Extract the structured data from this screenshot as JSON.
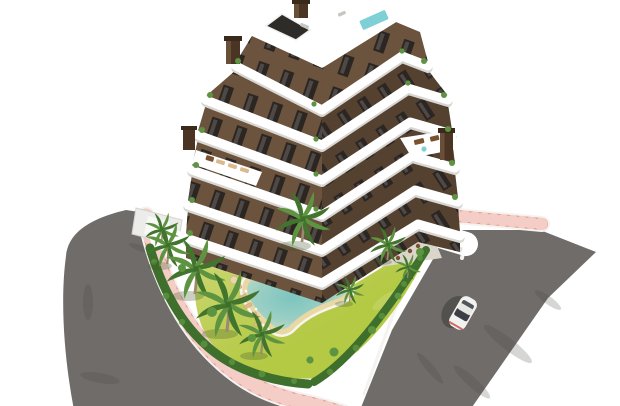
{
  "scene": {
    "type": "architectural_3d_render",
    "subject": "Aerial 3D render of a modern apartment residential complex with garden pool, palm trees and surrounding roads",
    "elements": {
      "building": {
        "label": "apartment building",
        "visible_levels": 7,
        "facade": "dark brown walls with white curved wrap-around balcony bands",
        "rooftop": [
          "roof terrace",
          "plunge pool",
          "stair core",
          "chimneys"
        ]
      },
      "garden": {
        "label": "landscaped garden",
        "features": [
          "free-form pool with beach edge",
          "sun loungers",
          "bright lawn",
          "palm trees",
          "perimeter hedge"
        ]
      },
      "roads": {
        "left": "curved asphalt road",
        "right": "straight asphalt road ending at render edge",
        "sidewalk": "salmon pink paving with joint lines"
      },
      "vehicle": {
        "type": "car",
        "color": "white",
        "location": "right road"
      }
    },
    "counts": {
      "palm_trees": 9,
      "poolside_loungers": 6,
      "cars": 1,
      "chimneys": 4
    },
    "colors": {
      "background": "#ffffff",
      "road": "#6f6c69",
      "road_stain": "#4a4846",
      "sidewalk": "#e89a8e",
      "curb": "#f5f3f0",
      "white_wall": "#ececea",
      "lawn": "#b4c944",
      "lawn_light": "#cdd876",
      "hedge": "#3f6f2c",
      "hedge_light": "#5d9441",
      "palm": "#5e9441",
      "palm_dark": "#41752e",
      "trunk": "#9b8a6e",
      "pool_water": "#7cc5bf",
      "pool_mid": "#9ccfc4",
      "pool_fade": "#d6dfc0",
      "pool_sand": "#e9d8a4",
      "pool_deck": "#f6f4ef",
      "lounger_tan": "#dcb98c",
      "rock_bed": "#d9cdb0",
      "rock": "#f0ece2",
      "slab": "#ffffff",
      "slab_shadow": "#d8d6d2",
      "wall_light": "#6b533d",
      "wall_dark": "#54412f",
      "window": "#2c2622",
      "paving": "#dcd5cb",
      "wood": "#7a5232",
      "roof_pool": "#7fd0d6",
      "stair_glass": "#2e2c29",
      "car_body": "#f2f2f0",
      "car_glass": "#3c4046",
      "shadow": "rgba(0,0,0,0.25)",
      "green_shadow": "rgba(60,85,40,0.28)"
    }
  }
}
